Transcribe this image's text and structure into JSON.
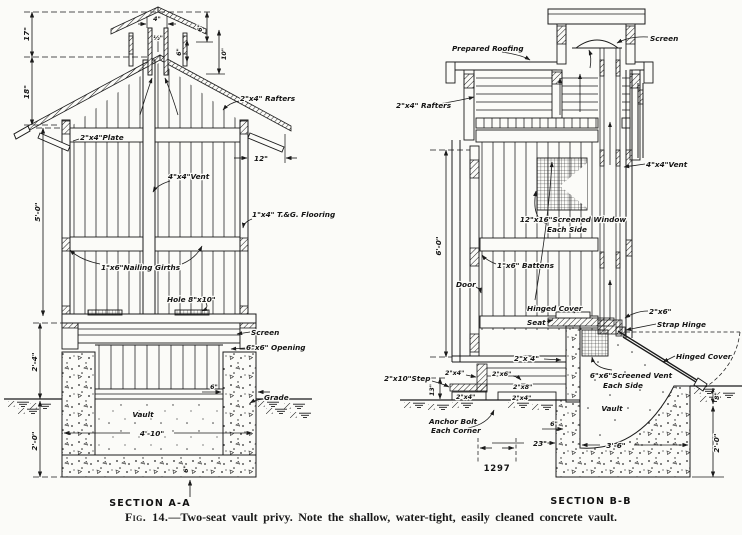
{
  "caption": {
    "prefix": "Fig. 14.",
    "text": "—Two-seat vault privy.  Note the shallow, water-tight, easily cleaned concrete vault."
  },
  "plate_number": "1297",
  "section_a": {
    "title": "SECTION A-A",
    "labels": {
      "rafters": "2\"x4\" Rafters",
      "plate": "2\"x4\"Plate",
      "vent": "4\"x4\"Vent",
      "flooring": "1\"x4\" T.&G. Flooring",
      "girths": "1\"x6\"Nailing Girths",
      "hole": "Hole 8\"x10\"",
      "screen": "Screen",
      "opening": "6\"x6\" Opening",
      "grade": "Grade",
      "vault": "Vault"
    },
    "dims": {
      "cupola_top": "17\"",
      "roof": "18\"",
      "shaft_width": "4\"",
      "shaft_wall": "½\"",
      "cap_height": "6\"",
      "vent_opening": "6\"",
      "cupola_height": "10\"",
      "eave": "12\"",
      "wall_height": "5'-0\"",
      "floor_to_grade": "2'-4\"",
      "vault_depth": "2'-0\"",
      "vault_width": "4'-10\"",
      "wall_thickness": "6\"",
      "slab": "6\""
    }
  },
  "section_b": {
    "title": "SECTION B-B",
    "labels": {
      "prepared_roofing": "Prepared Roofing",
      "screen": "Screen",
      "rafters": "2\"x4\" Rafters",
      "vent": "4\"x4\"Vent",
      "window_line1": "12\"x16\"Screened Window",
      "window_line2": "Each Side",
      "battens": "1\"x6\" Battens",
      "door": "Door",
      "hinged_cover_seat": "Hinged Cover",
      "seat": "Seat",
      "vent_sill": "2\"x6\"",
      "strap_hinge": "Strap Hinge",
      "hinged_cover_open": "Hinged Cover",
      "frame_2x4_riser": "2\"x 4\"",
      "riser_width": "4\"",
      "screened_vent_line1": "6\"x6\"Screened Vent",
      "screened_vent_line2": "Each Side",
      "step": "2\"x10\"Step",
      "frame_2x4_a": "2\"x4\"",
      "frame_2x6": "2\"x6\"",
      "frame_2x8": "2\"x8\"",
      "frame_2x4_b": "2\"x4\"",
      "frame_2x4_c": "2\"x4\"",
      "anchor_line1": "Anchor Bolt",
      "anchor_line2": "Each Corner",
      "vault": "Vault"
    },
    "dims": {
      "wall_height": "6'-0\"",
      "step_rise": "13\"",
      "offset": "23\"",
      "vault_width": "3'-6\"",
      "wall_thickness": "6\"",
      "freeboard": "8\"",
      "vault_depth": "2'-0\""
    }
  }
}
